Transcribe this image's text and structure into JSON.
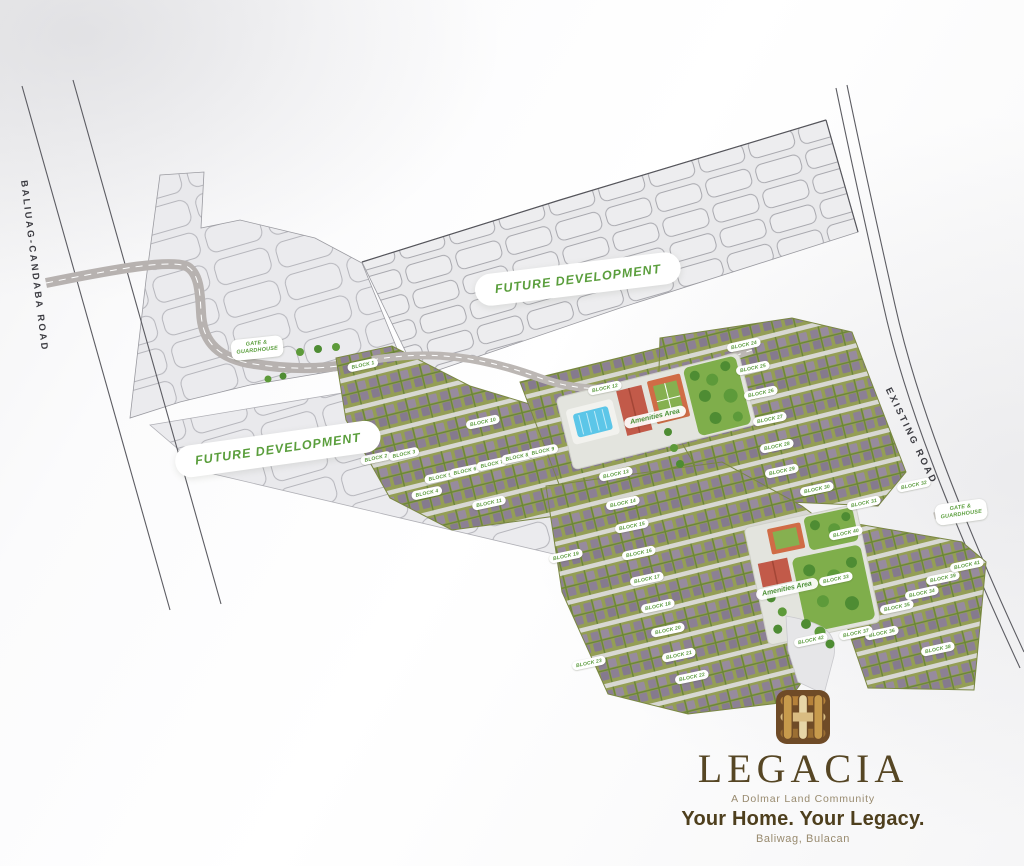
{
  "branding": {
    "name": "LEGACIA",
    "community": "A Dolmar Land Community",
    "tagline": "Your Home. Your Legacy.",
    "location": "Baliwag, Bulacan",
    "logo_icon": "woven-square-logo",
    "colors": {
      "brand_brown": "#564624",
      "logo_square": "#6f4b27",
      "logo_gold": "#c79a4c",
      "muted_brown": "#988a6e"
    }
  },
  "map": {
    "colors": {
      "accent_green": "#5a9e3c",
      "lot_green": "#949e55",
      "roof_purple": "#8c8094",
      "road_gray": "#bcb7b4",
      "future_dev_gray": "#e9e9eb",
      "lawn_green": "#7fae4b",
      "pool_blue": "#5cc6e8",
      "court_orange": "#d06c46",
      "boundary_gray": "#55555b"
    },
    "road_labels": [
      {
        "label": "BALIUAG-CANDABA ROAD",
        "x": 34,
        "y": 266,
        "rot": 83
      },
      {
        "label": "EXISTING ROAD",
        "x": 911,
        "y": 436,
        "rot": 64
      }
    ],
    "future_development": [
      {
        "label": "FUTURE DEVELOPMENT",
        "x": 578,
        "y": 279,
        "rot": -7
      },
      {
        "label": "FUTURE DEVELOPMENT",
        "x": 278,
        "y": 449,
        "rot": -8
      }
    ],
    "gates": [
      {
        "label": "GATE &\nGUARDHOUSE",
        "x": 257,
        "y": 348,
        "rot": -6
      },
      {
        "label": "GATE &\nGUARDHOUSE",
        "x": 961,
        "y": 512,
        "rot": -8
      }
    ],
    "amenities": [
      {
        "label": "Amenities Area",
        "x": 655,
        "y": 417,
        "rot": -13
      },
      {
        "label": "Amenities Area",
        "x": 787,
        "y": 589,
        "rot": -12
      }
    ],
    "blocks": [
      {
        "label": "BLOCK 1",
        "x": 363,
        "y": 365
      },
      {
        "label": "BLOCK 2",
        "x": 376,
        "y": 458
      },
      {
        "label": "BLOCK 3",
        "x": 404,
        "y": 454
      },
      {
        "label": "BLOCK 4",
        "x": 427,
        "y": 493
      },
      {
        "label": "BLOCK 5",
        "x": 440,
        "y": 477
      },
      {
        "label": "BLOCK 6",
        "x": 465,
        "y": 471
      },
      {
        "label": "BLOCK 7",
        "x": 492,
        "y": 464
      },
      {
        "label": "BLOCK 8",
        "x": 517,
        "y": 457
      },
      {
        "label": "BLOCK 9",
        "x": 543,
        "y": 451
      },
      {
        "label": "BLOCK 10",
        "x": 483,
        "y": 422
      },
      {
        "label": "BLOCK 11",
        "x": 489,
        "y": 503
      },
      {
        "label": "BLOCK 12",
        "x": 605,
        "y": 388
      },
      {
        "label": "BLOCK 13",
        "x": 616,
        "y": 474
      },
      {
        "label": "BLOCK 14",
        "x": 623,
        "y": 503
      },
      {
        "label": "BLOCK 15",
        "x": 632,
        "y": 526
      },
      {
        "label": "BLOCK 16",
        "x": 639,
        "y": 553
      },
      {
        "label": "BLOCK 17",
        "x": 647,
        "y": 579
      },
      {
        "label": "BLOCK 18",
        "x": 658,
        "y": 606
      },
      {
        "label": "BLOCK 19",
        "x": 566,
        "y": 556
      },
      {
        "label": "BLOCK 20",
        "x": 668,
        "y": 630
      },
      {
        "label": "BLOCK 21",
        "x": 679,
        "y": 655
      },
      {
        "label": "BLOCK 22",
        "x": 692,
        "y": 677
      },
      {
        "label": "BLOCK 23",
        "x": 589,
        "y": 663
      },
      {
        "label": "BLOCK 24",
        "x": 744,
        "y": 345
      },
      {
        "label": "BLOCK 25",
        "x": 753,
        "y": 368
      },
      {
        "label": "BLOCK 26",
        "x": 761,
        "y": 393
      },
      {
        "label": "BLOCK 27",
        "x": 770,
        "y": 419
      },
      {
        "label": "BLOCK 28",
        "x": 777,
        "y": 446
      },
      {
        "label": "BLOCK 29",
        "x": 782,
        "y": 471
      },
      {
        "label": "BLOCK 30",
        "x": 817,
        "y": 489
      },
      {
        "label": "BLOCK 31",
        "x": 864,
        "y": 503
      },
      {
        "label": "BLOCK 32",
        "x": 914,
        "y": 485
      },
      {
        "label": "BLOCK 33",
        "x": 836,
        "y": 579
      },
      {
        "label": "BLOCK 34",
        "x": 922,
        "y": 593
      },
      {
        "label": "BLOCK 35",
        "x": 897,
        "y": 607
      },
      {
        "label": "BLOCK 36",
        "x": 882,
        "y": 633
      },
      {
        "label": "BLOCK 37",
        "x": 856,
        "y": 633
      },
      {
        "label": "BLOCK 38",
        "x": 938,
        "y": 649
      },
      {
        "label": "BLOCK 39",
        "x": 943,
        "y": 578
      },
      {
        "label": "BLOCK 40",
        "x": 846,
        "y": 533
      },
      {
        "label": "BLOCK 41",
        "x": 967,
        "y": 565
      },
      {
        "label": "BLOCK 42",
        "x": 811,
        "y": 640
      }
    ]
  }
}
